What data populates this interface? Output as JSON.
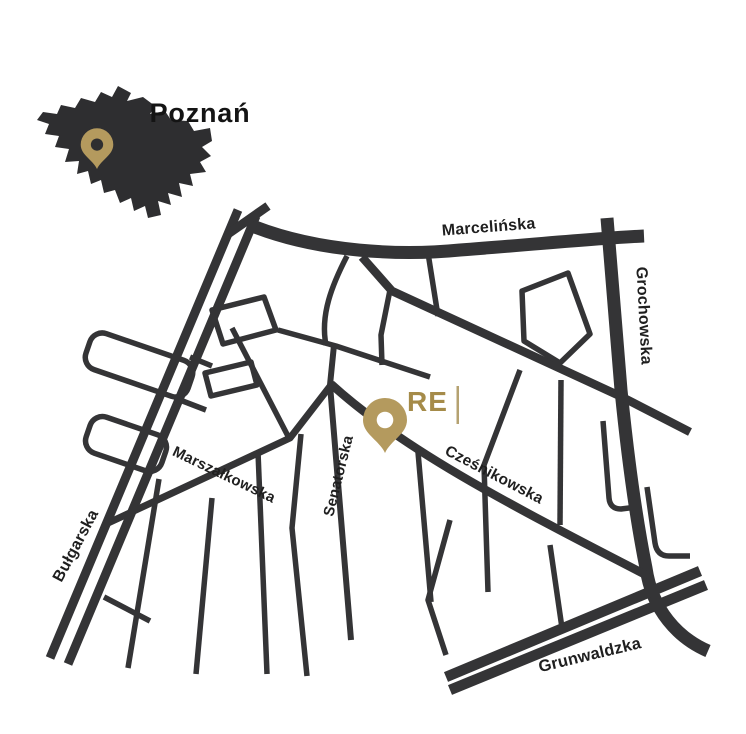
{
  "inset": {
    "city_label": "Poznań"
  },
  "marker": {
    "logo_text": "RE",
    "logo_divider": "|"
  },
  "streets": {
    "marcelinska": "Marcelińska",
    "grochowska": "Grochowska",
    "bulgarska": "Bułgarska",
    "marszalkowska": "Marszałkowska",
    "senatorska": "Senatorska",
    "czesnikowska": "Cześnikowska",
    "grunwaldzka": "Grunwaldzka"
  },
  "colors": {
    "background": "#ffffff",
    "road": "#343436",
    "street_label": "#1f1f1f",
    "city_silhouette": "#2e2e30",
    "pin_gold": "#b49a5e",
    "logo_gold": "#a58b49",
    "logo_divider_gold": "#b5a271"
  }
}
